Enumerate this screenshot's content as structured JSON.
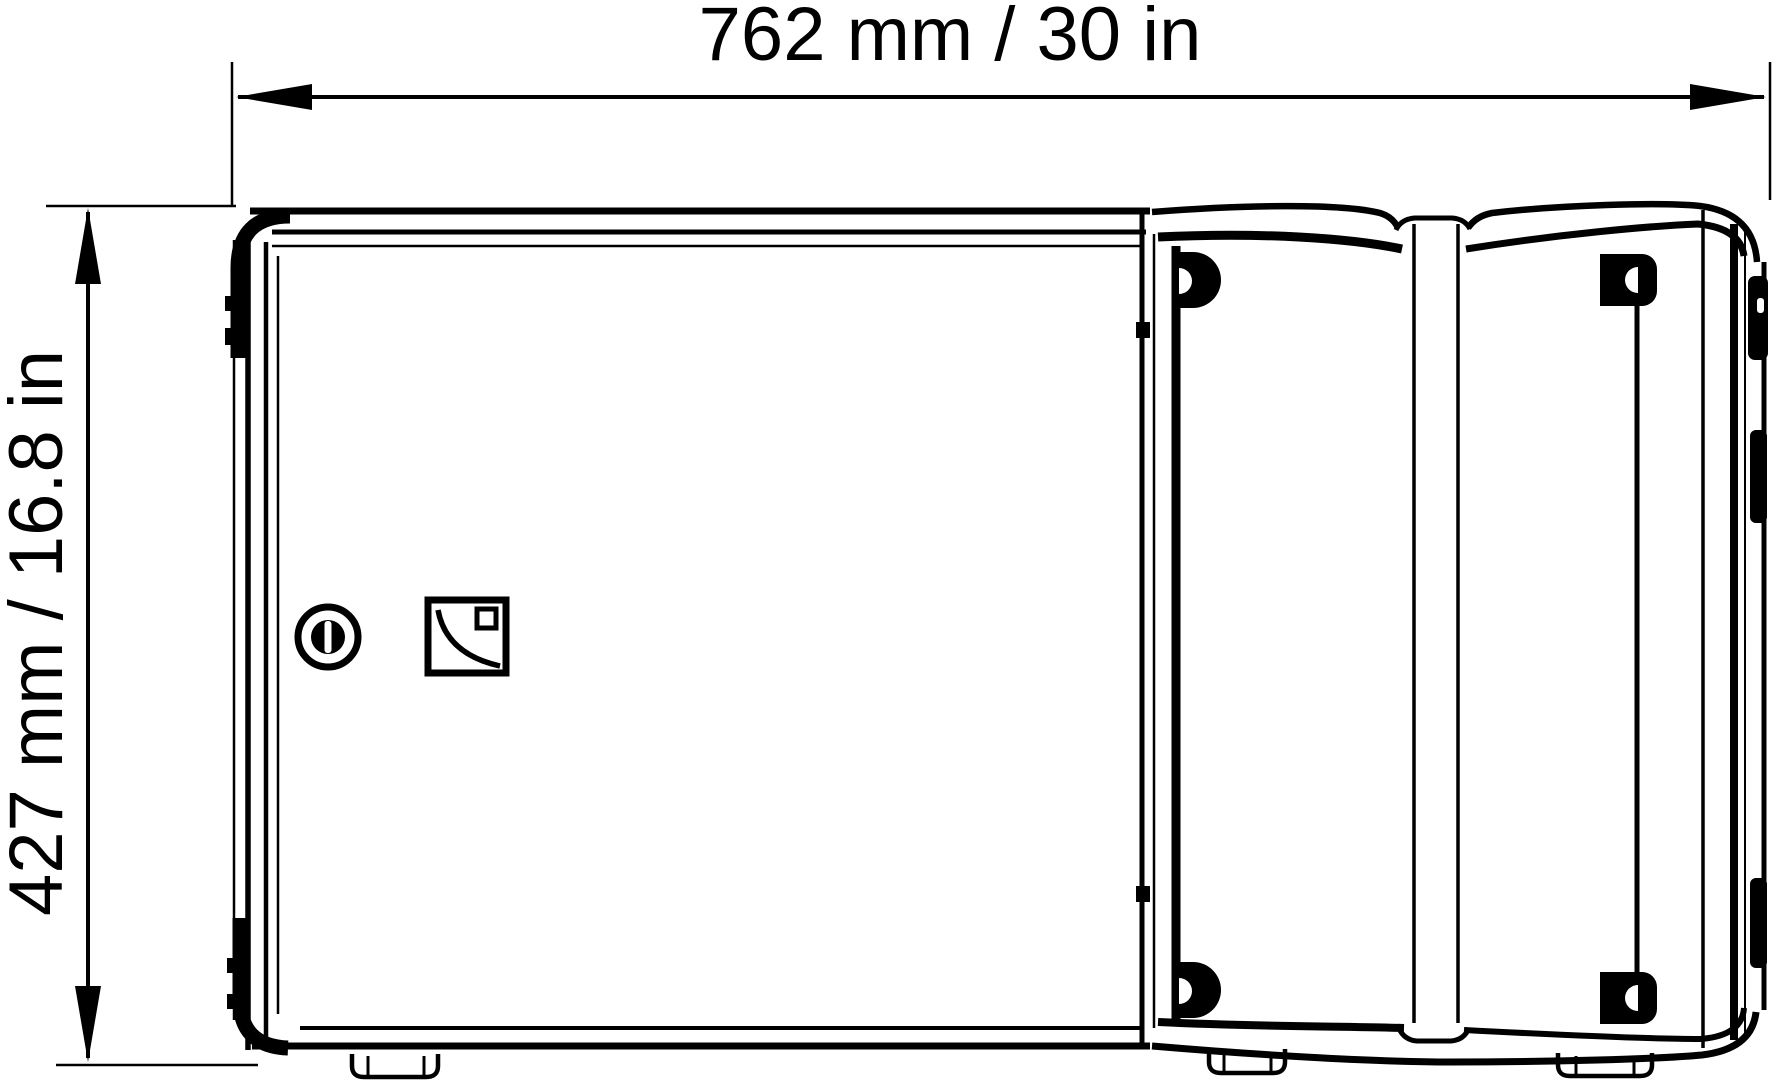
{
  "drawing": {
    "subject": "loudspeaker-enclosure-top-view",
    "background_color": "#ffffff",
    "line_color": "#000000",
    "dimensions": {
      "width_label": "762 mm / 30 in",
      "height_label": "427 mm / 16.8 in"
    },
    "icons": {
      "latch": "slot-latch-icon",
      "brand_logo": "l-acoustics-logo-icon"
    }
  }
}
